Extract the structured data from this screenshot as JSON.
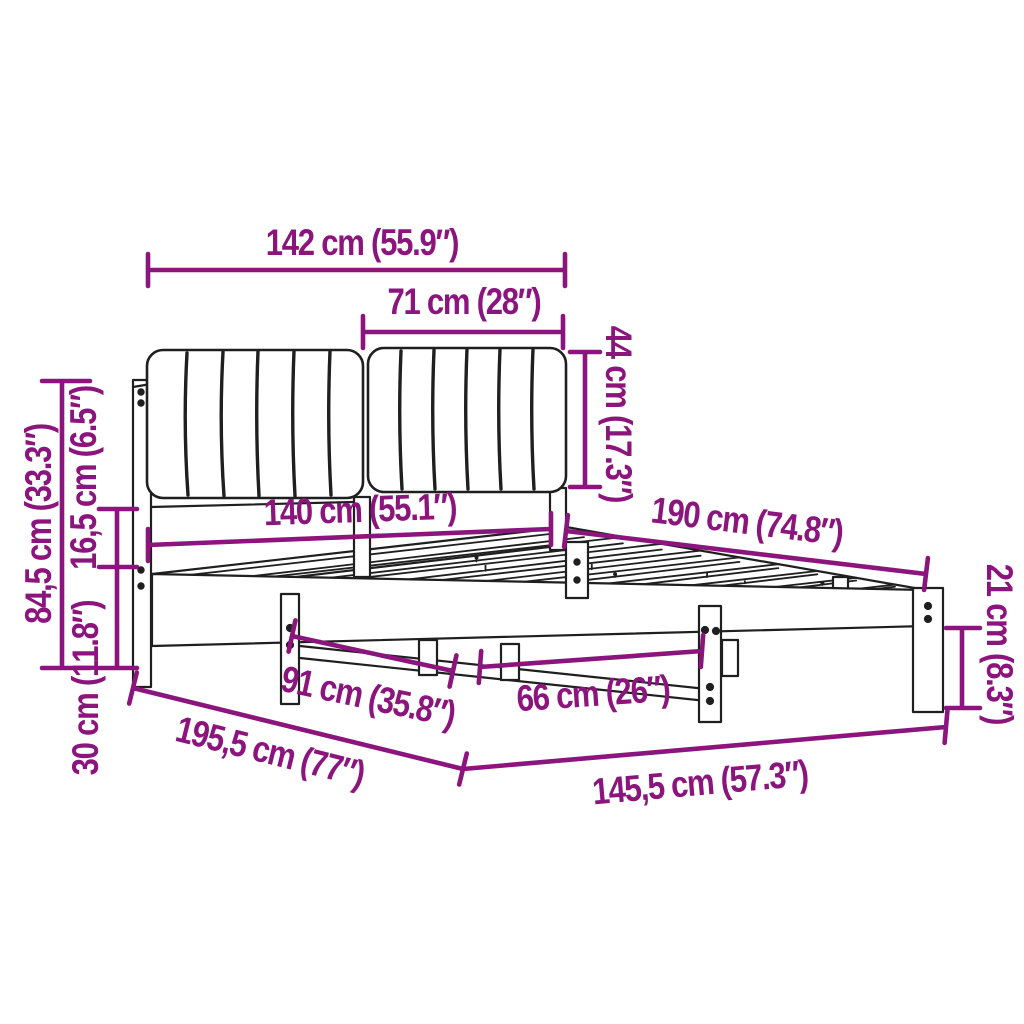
{
  "figure": {
    "type": "product-dimension-diagram",
    "subject": "bed frame with upholstered headboard"
  },
  "colors": {
    "dimension": "#8C147D",
    "line": "#1f1f1f",
    "background": "#FFFFFF"
  },
  "labels": {
    "w142": "142 cm (55.9″)",
    "w71": "71 cm (28″)",
    "h44": "44 cm (17.3″)",
    "w140": "140 cm (55.1″)",
    "l190": "190 cm (74.8″)",
    "h845": "84,5 cm (33.3″)",
    "h165": "16,5 cm (6.5″)",
    "h30": "30 cm (11.8″)",
    "s91": "91 cm (35.8″)",
    "s66": "66 cm (26″)",
    "l1955": "195,5 cm (77″)",
    "l1455": "145,5 cm (57.3″)",
    "h21": "21 cm (8.3″)"
  }
}
